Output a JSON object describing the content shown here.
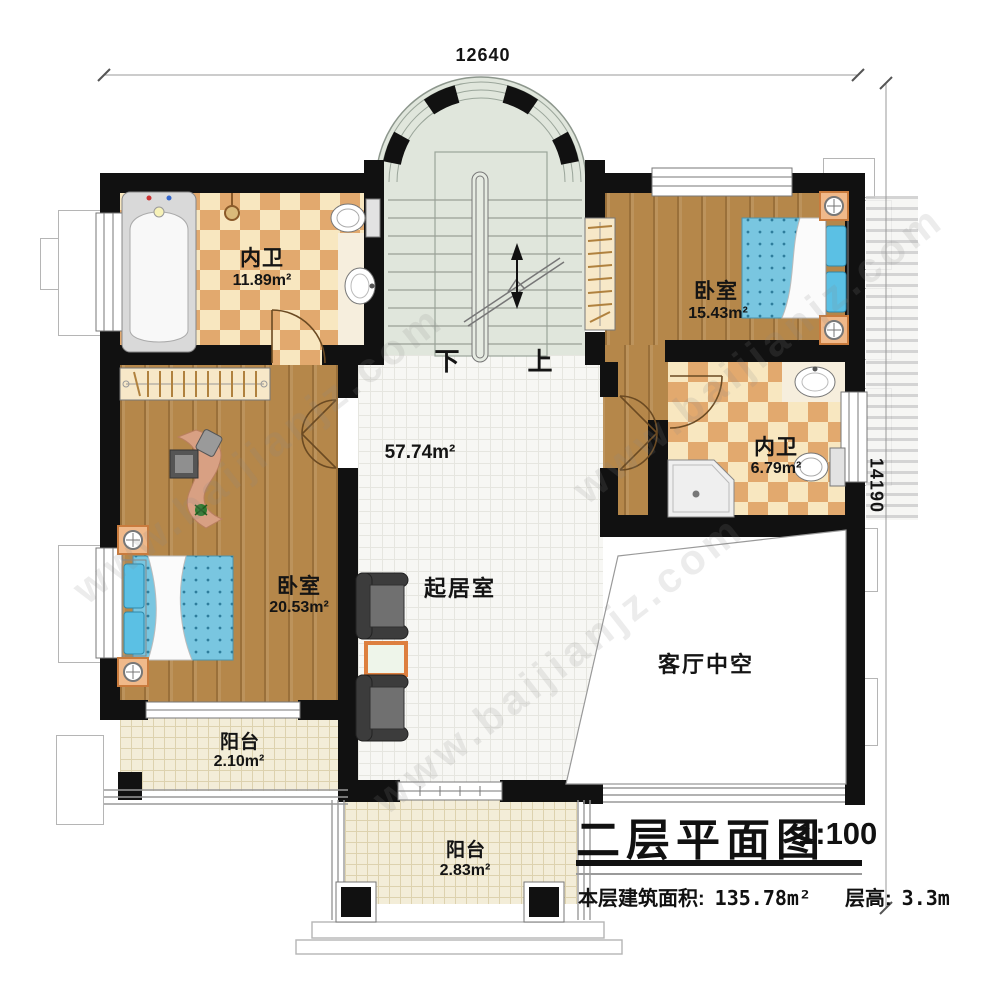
{
  "dimensions": {
    "top": "12640",
    "right": "14190"
  },
  "rooms": {
    "bath1": {
      "name": "内卫",
      "area": "11.89m²"
    },
    "bed1": {
      "name": "卧室",
      "area": "15.43m²"
    },
    "bath2": {
      "name": "内卫",
      "area": "6.79m²"
    },
    "bed2": {
      "name": "卧室",
      "area": "20.53m²"
    },
    "living": {
      "name": "起居室",
      "area": "57.74m²"
    },
    "void": {
      "name": "客厅中空"
    },
    "balcony1": {
      "name": "阳台",
      "area": "2.10m²"
    },
    "balcony2": {
      "name": "阳台",
      "area": "2.83m²"
    }
  },
  "stairs": {
    "down": "下",
    "up": "上"
  },
  "titleblock": {
    "title": "二层平面图",
    "scale": "1:100",
    "area_label": "本层建筑面积:",
    "area_value": "135.78m²",
    "height_label": "层高:",
    "height_value": "3.3m"
  },
  "watermark": "www.baijianjz.com",
  "colors": {
    "wall": "#111111",
    "wood": "#b5874a",
    "tile_dark": "#e2a96e",
    "tile_light": "#f8e7c0",
    "bed_blue": "#79c6e0",
    "accent_orange": "#dd7f3f",
    "stair_floor": "#e0e6dc"
  }
}
